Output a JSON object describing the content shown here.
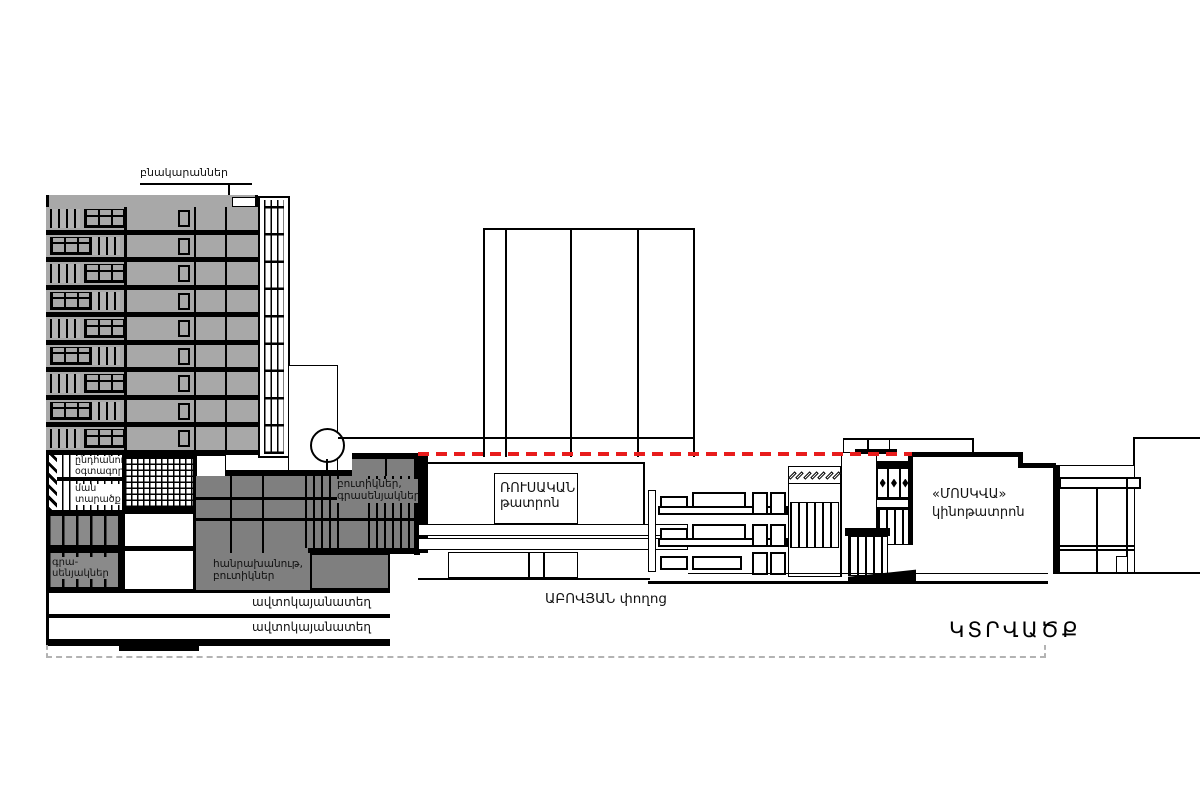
{
  "colors": {
    "floor_gray": "#a8a8a8",
    "podium_gray": "#7f7f7f",
    "dark_stripe_gray": "#8a8a8a",
    "section_red": "#e81c1c",
    "dashed_outline_gray": "#b3b3b3",
    "line_black": "#000000"
  },
  "labels": {
    "apartments": "բնակարաններ",
    "common_use_upper": "ընդհանուր\nօգտագործ",
    "common_use_lower": "ման\nտարածք",
    "offices": "գրա-\nսենյակներ",
    "department_store": "հանրախանութ,\nբուտիկներ",
    "boutiques_offices": "բուտիկներ,\nգրասենյակներ",
    "parking_upper": "ավտոկայանատեղ",
    "parking_lower": "ավտոկայանատեղ",
    "russian_theater": "ՌՈՒՍԱԿԱՆ\nթատրոն",
    "moskva_cinema": "«ՄՈՍԿՎԱ»\nկինոթատրոն",
    "abovyan_street": "ԱԲՈՎՅԱՆ փողոց",
    "section_title": "ԿՏՐՎԱԾՔ"
  },
  "tower": {
    "floors_count": 9
  },
  "cinema": {
    "frieze_diamond_count": 7,
    "ornament_diamond_count": 3
  }
}
